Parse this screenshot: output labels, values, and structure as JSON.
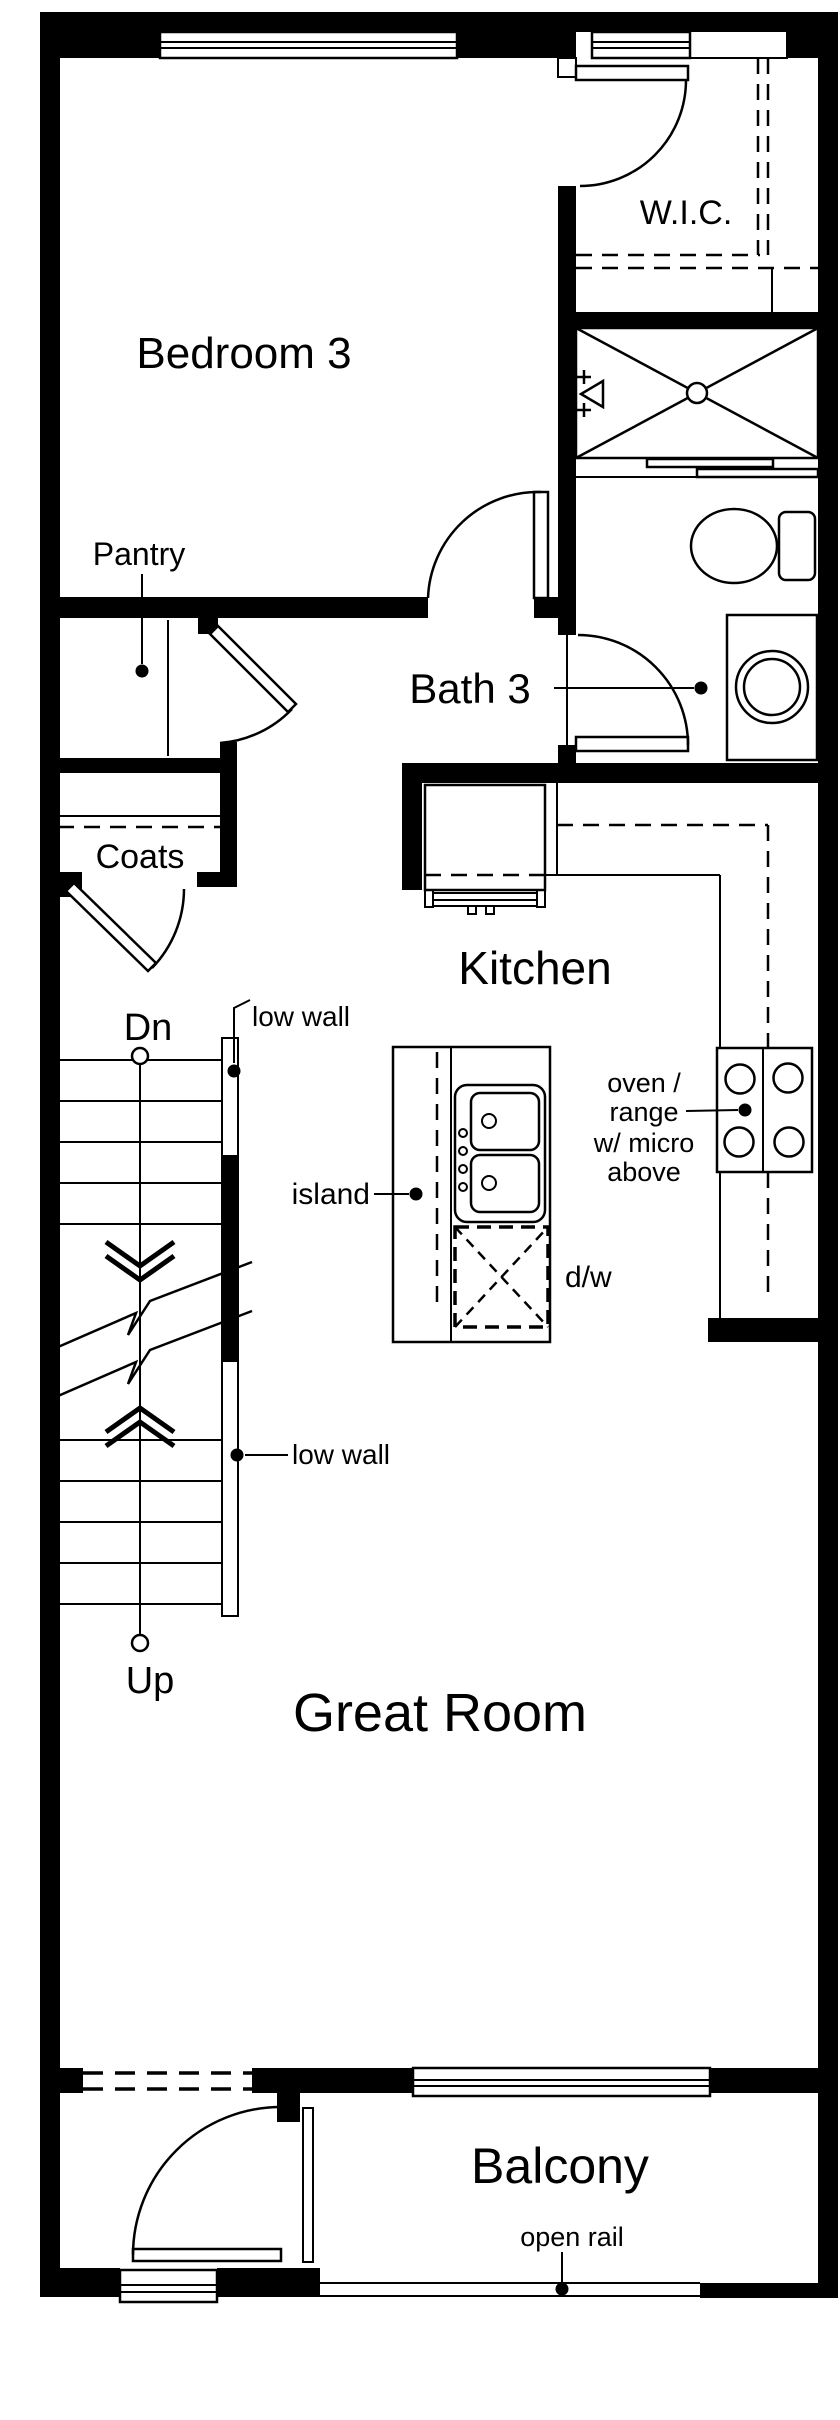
{
  "title": "Floor plan",
  "colors": {
    "line": "#000000",
    "background": "#ffffff"
  },
  "rooms": {
    "bedroom3": {
      "label": "Bedroom 3"
    },
    "wic": {
      "label": "W.I.C."
    },
    "bath3": {
      "label": "Bath 3"
    },
    "pantry": {
      "label": "Pantry"
    },
    "coats": {
      "label": "Coats"
    },
    "kitchen": {
      "label": "Kitchen"
    },
    "great_room": {
      "label": "Great Room"
    },
    "balcony": {
      "label": "Balcony"
    }
  },
  "stairs": {
    "down_label": "Dn",
    "up_label": "Up"
  },
  "annotations": {
    "low_wall_upper": {
      "label": "low wall"
    },
    "low_wall_lower": {
      "label": "low wall"
    },
    "island": {
      "label": "island"
    },
    "dishwasher": {
      "label": "d/w"
    },
    "oven_range": {
      "lines": [
        "oven /",
        "range",
        "w/ micro",
        "above"
      ]
    },
    "open_rail": {
      "label": "open rail"
    }
  }
}
